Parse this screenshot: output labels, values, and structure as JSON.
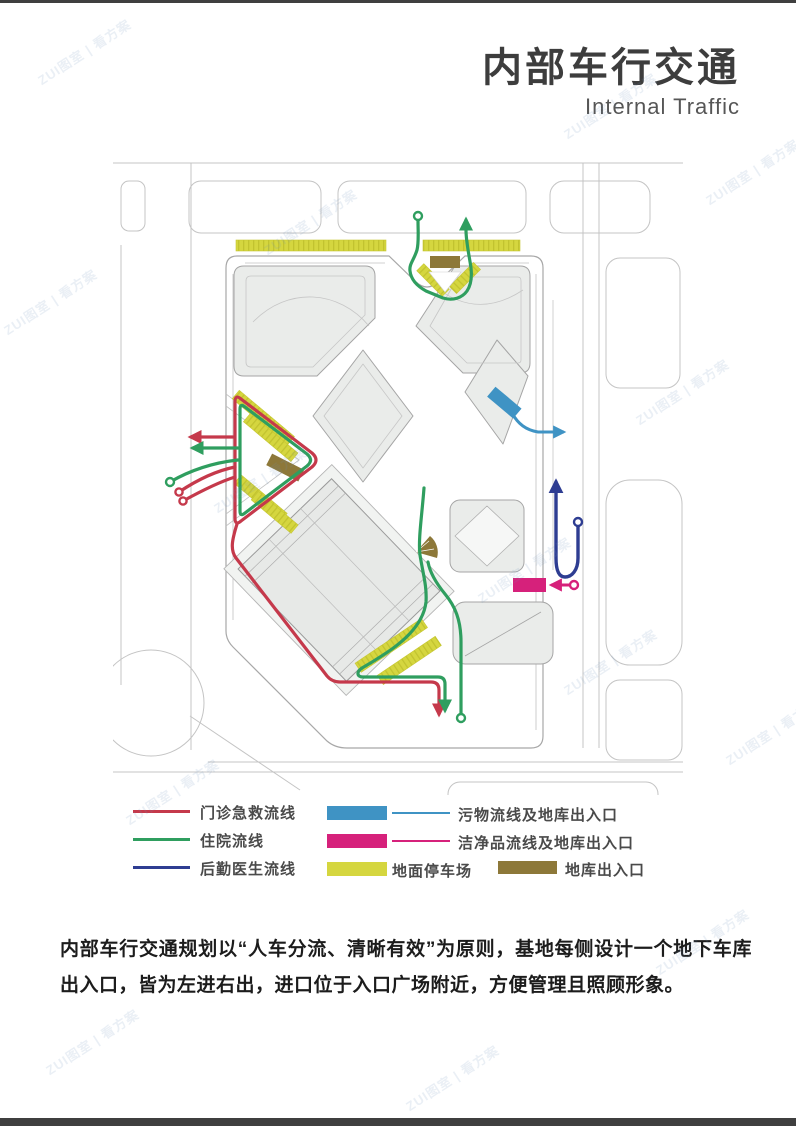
{
  "header": {
    "title": "内部车行交通",
    "subtitle": "Internal Traffic"
  },
  "legend": {
    "line_items": [
      {
        "label": "门诊急救流线",
        "color": "#c5394b",
        "type": "line"
      },
      {
        "label": "住院流线",
        "color": "#2f9e5f",
        "type": "line"
      },
      {
        "label": "后勤医生流线",
        "color": "#2e3d92",
        "type": "line"
      }
    ],
    "area_items": [
      {
        "label": "污物流线及地库出入口",
        "color": "#3f93c4",
        "type": "rect-and-line"
      },
      {
        "label": "洁净品流线及地库出入口",
        "color": "#d6217b",
        "type": "rect-and-line"
      },
      {
        "label": "地面停车场",
        "color": "#d5d63f",
        "type": "rect"
      },
      {
        "label": "地库出入口",
        "color": "#8d7839",
        "type": "rect"
      }
    ]
  },
  "description": "内部车行交通规划以“人车分流、清晰有效”为原则，基地每侧设计一个地下车库出入口，皆为左进右出，进口位于入口广场附近，方便管理且照顾形象。",
  "map": {
    "colors": {
      "outpatient_emergency": "#c5394b",
      "inpatient": "#2f9e5f",
      "logistics_doctor": "#2e3d92",
      "waste": "#3f93c4",
      "clean_supply": "#d6217b",
      "surface_parking": "#d5d63f",
      "garage_entrance": "#8d7839",
      "road": "#c4c4c4",
      "block_fill": "#eaecea"
    }
  },
  "watermark": {
    "text": "ZUI图室 | 看方案",
    "positions": [
      [
        30,
        42
      ],
      [
        556,
        96
      ],
      [
        -4,
        292
      ],
      [
        628,
        382
      ],
      [
        206,
        470
      ],
      [
        698,
        162
      ],
      [
        118,
        782
      ],
      [
        556,
        652
      ],
      [
        398,
        1068
      ],
      [
        648,
        932
      ],
      [
        38,
        1032
      ],
      [
        256,
        212
      ],
      [
        718,
        722
      ],
      [
        470,
        560
      ]
    ]
  }
}
